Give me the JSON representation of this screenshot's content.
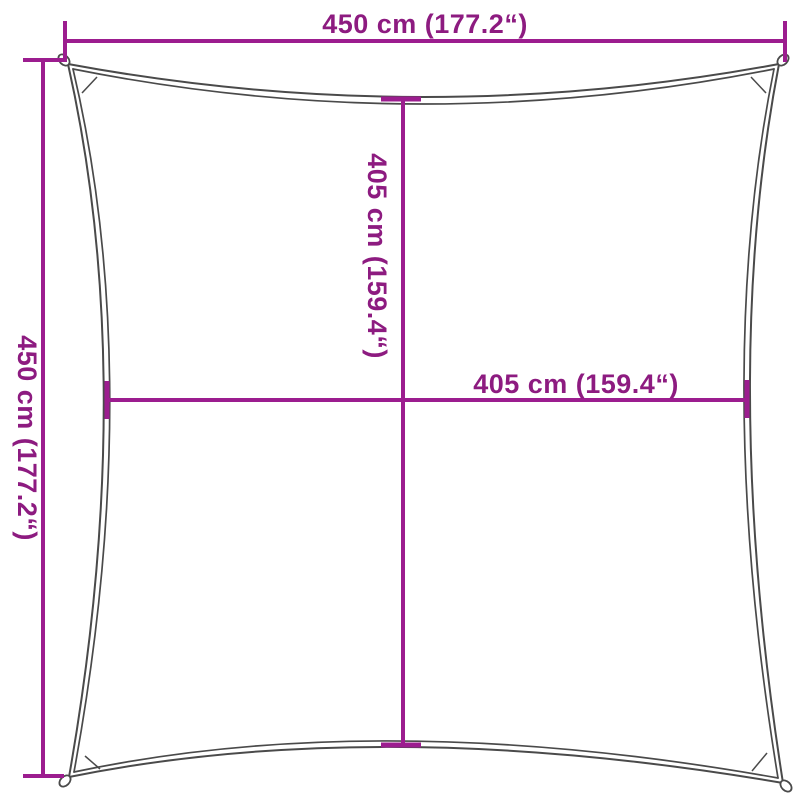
{
  "diagram": {
    "type": "product-dimension-diagram",
    "subject": "square shade sail with corner rings, concave edges",
    "colors": {
      "dimension-line": "#9c1d8f",
      "dimension-text": "#8d1b80",
      "sail-outline": "#4a4a4a",
      "background": "#ffffff"
    },
    "dimensions": {
      "outer_width_top": "450 cm (177.2“)",
      "outer_height_left": "450 cm (177.2“)",
      "inner_height_center": "405 cm (159.4“)",
      "inner_width_center": "405 cm (159.4“)"
    }
  }
}
